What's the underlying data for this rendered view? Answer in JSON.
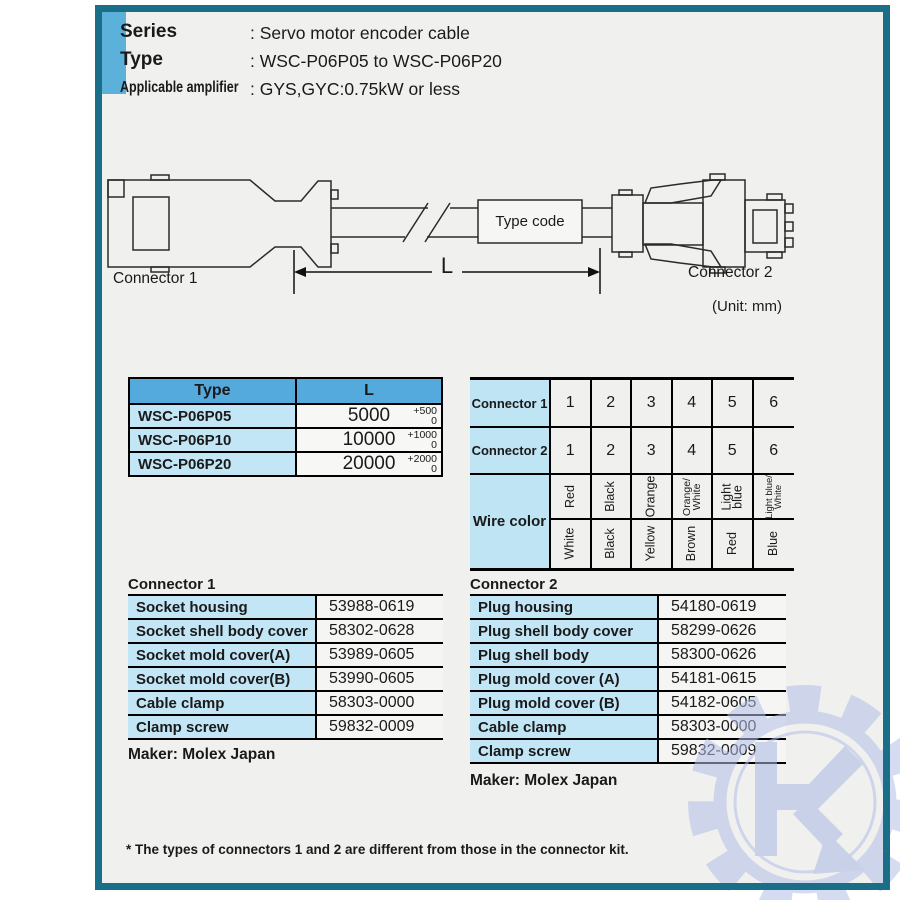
{
  "header": {
    "rows": [
      {
        "label": "Series",
        "value": ": Servo motor encoder cable"
      },
      {
        "label": "Type",
        "value": ": WSC-P06P05 to WSC-P06P20"
      },
      {
        "label": "Applicable amplifier",
        "value": ": GYS,GYC:0.75kW or less"
      }
    ]
  },
  "diagram": {
    "connector1_label": "Connector 1",
    "connector2_label": "Connector 2",
    "type_code_label": "Type code",
    "length_label": "L",
    "unit_label": "(Unit: mm)"
  },
  "type_table": {
    "headers": [
      "Type",
      "L"
    ],
    "rows": [
      {
        "type": "WSC-P06P05",
        "length": "5000",
        "tol_plus": "+500",
        "tol_minus": "0"
      },
      {
        "type": "WSC-P06P10",
        "length": "10000",
        "tol_plus": "+1000",
        "tol_minus": "0"
      },
      {
        "type": "WSC-P06P20",
        "length": "20000",
        "tol_plus": "+2000",
        "tol_minus": "0"
      }
    ]
  },
  "wire_table": {
    "row1_label": "Connector 1",
    "row2_label": "Connector 2",
    "row3_label": "Wire color",
    "pins1": [
      "1",
      "2",
      "3",
      "4",
      "5",
      "6"
    ],
    "pins2": [
      "1",
      "2",
      "3",
      "4",
      "5",
      "6"
    ],
    "colors_top": [
      [
        "Red"
      ],
      [
        "Black"
      ],
      [
        "Orange"
      ],
      [
        "Orange/",
        "White"
      ],
      [
        "Light",
        "blue"
      ],
      [
        "Light blue/",
        "White"
      ]
    ],
    "colors_bottom": [
      "White",
      "Black",
      "Yellow",
      "Brown",
      "Red",
      "Blue"
    ]
  },
  "connector1_table": {
    "title": "Connector 1",
    "rows": [
      {
        "label": "Socket housing",
        "value": "53988-0619"
      },
      {
        "label": "Socket shell body cover",
        "value": "58302-0628"
      },
      {
        "label": "Socket mold cover(A)",
        "value": "53989-0605"
      },
      {
        "label": "Socket mold cover(B)",
        "value": "53990-0605"
      },
      {
        "label": "Cable clamp",
        "value": "58303-0000"
      },
      {
        "label": "Clamp screw",
        "value": "59832-0009"
      }
    ],
    "maker": "Maker: Molex Japan"
  },
  "connector2_table": {
    "title": "Connector 2",
    "rows": [
      {
        "label": "Plug housing",
        "value": "54180-0619"
      },
      {
        "label": "Plug shell body cover",
        "value": "58299-0626"
      },
      {
        "label": "Plug shell body",
        "value": "58300-0626"
      },
      {
        "label": "Plug mold cover (A)",
        "value": "54181-0615"
      },
      {
        "label": "Plug mold cover (B)",
        "value": "54182-0605"
      },
      {
        "label": "Cable clamp",
        "value": "58303-0000"
      },
      {
        "label": "Clamp screw",
        "value": "59832-0009"
      }
    ],
    "maker": "Maker: Molex Japan"
  },
  "footnote": "* The types of connectors 1 and 2 are different from those in the connector kit.",
  "colors": {
    "border_teal": "#1a6e88",
    "accent_bar_blue": "#5cb1da",
    "table_header_blue": "#55aadd",
    "cell_light_blue": "#c2e6f5",
    "watermark_periwinkle": "#b4c0e8"
  }
}
